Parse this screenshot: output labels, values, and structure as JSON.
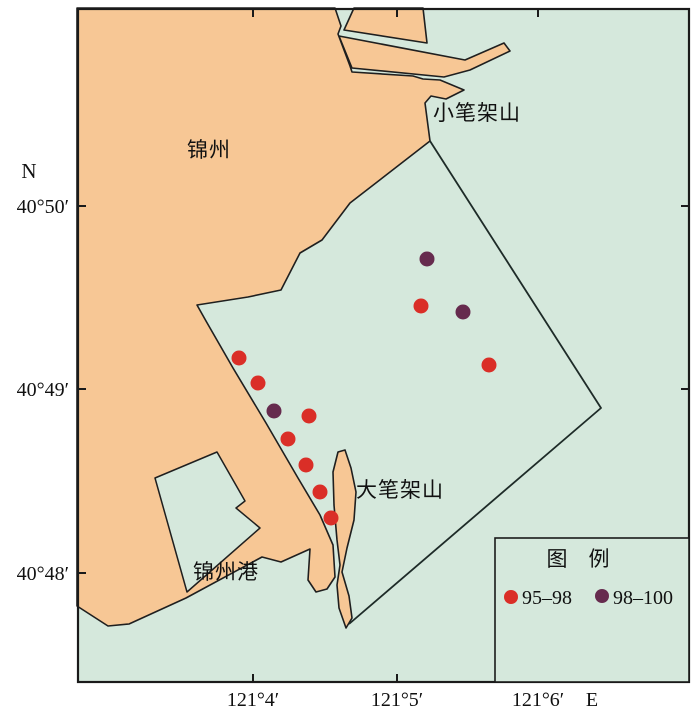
{
  "axes": {
    "north_label": "N",
    "east_label": "E",
    "y_ticks": [
      {
        "label": "40°50′",
        "y": 206
      },
      {
        "label": "40°49′",
        "y": 389
      },
      {
        "label": "40°48′",
        "y": 573
      }
    ],
    "x_ticks": [
      {
        "label": "121°4′",
        "x": 253
      },
      {
        "label": "121°5′",
        "x": 397
      },
      {
        "label": "121°6′",
        "x": 538
      }
    ]
  },
  "places": {
    "jinzhou": "锦州",
    "xiaobijiashan": "小笔架山",
    "dabijiashan": "大笔架山",
    "jinzhou_port": "锦州港"
  },
  "legend": {
    "title": "图　例",
    "items": [
      {
        "label": "95–98",
        "range": "95-98",
        "color": "#da2e27"
      },
      {
        "label": "98–100",
        "range": "98-100",
        "color": "#662b4e"
      }
    ]
  },
  "stations": [
    {
      "x": 427,
      "y": 259,
      "range": "98-100"
    },
    {
      "x": 421,
      "y": 306,
      "range": "95-98"
    },
    {
      "x": 463,
      "y": 312,
      "range": "98-100"
    },
    {
      "x": 489,
      "y": 365,
      "range": "95-98"
    },
    {
      "x": 239,
      "y": 358,
      "range": "95-98"
    },
    {
      "x": 258,
      "y": 383,
      "range": "95-98"
    },
    {
      "x": 274,
      "y": 411,
      "range": "98-100"
    },
    {
      "x": 309,
      "y": 416,
      "range": "95-98"
    },
    {
      "x": 288,
      "y": 439,
      "range": "95-98"
    },
    {
      "x": 306,
      "y": 465,
      "range": "95-98"
    },
    {
      "x": 320,
      "y": 492,
      "range": "95-98"
    },
    {
      "x": 331,
      "y": 518,
      "range": "95-98"
    }
  ],
  "colors": {
    "water": "#d5e8dc",
    "land": "#f7c795",
    "outline": "#1f1f1f"
  }
}
